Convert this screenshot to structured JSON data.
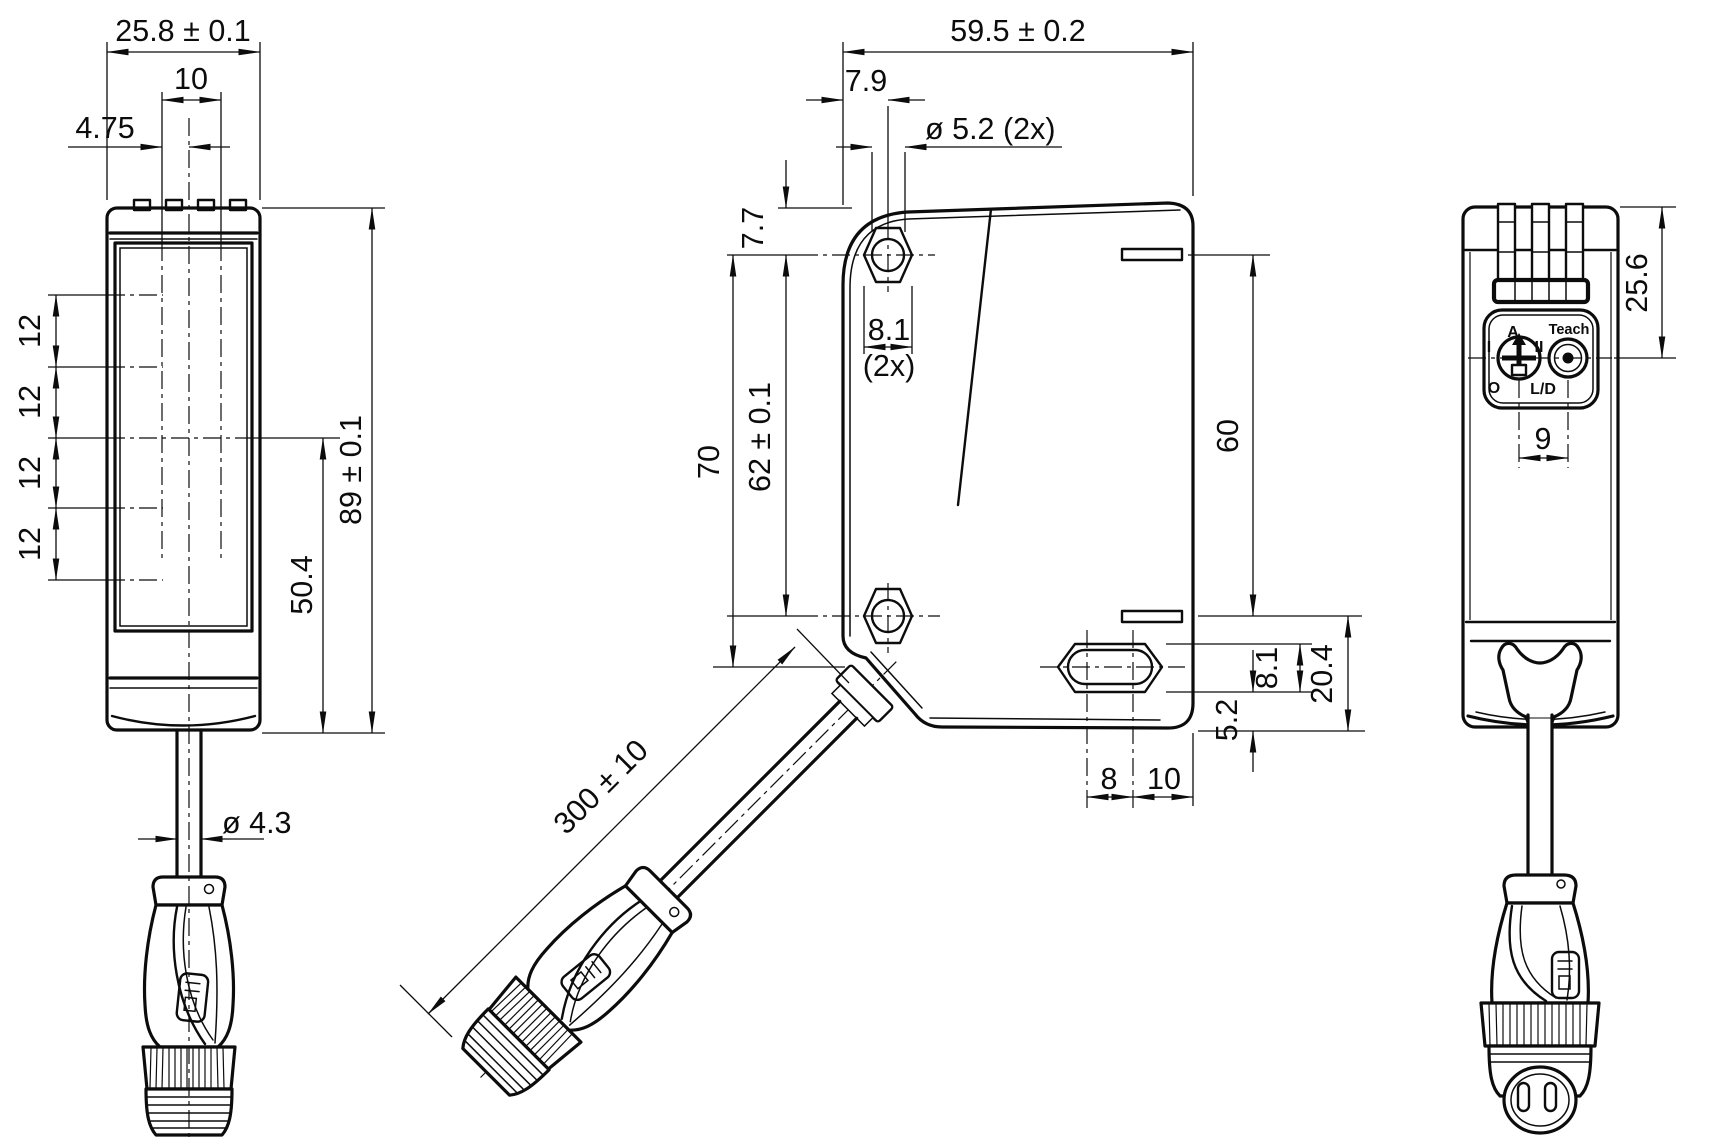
{
  "front": {
    "total_width": "25.8 ± 0.1",
    "window_width": "10",
    "axis_offset": "4.75",
    "beam_pitch": [
      "12",
      "12",
      "12",
      "12"
    ],
    "height": "89 ± 0.1",
    "axis_height": "50.4",
    "cable_dia": "ø 4.3"
  },
  "side": {
    "depth": "59.5 ± 0.2",
    "hole_offset": "7.9",
    "hole_dia": "ø 5.2 (2x)",
    "top_to_hole": "7.7",
    "hole_to_slot": "70",
    "hole_pitch": "62 ± 0.1",
    "hex_width": "8.1",
    "hex_qty": "(2x)",
    "back_pitch": "60",
    "slot_width": "8.1",
    "slot_zone": "20.4",
    "slot_to_bottom": "5.2",
    "slot_len": "8",
    "slot_to_back": "10",
    "cable_length": "300 ± 10"
  },
  "back": {
    "top_to_axis": "25.6",
    "control_pitch": "9",
    "pot": {
      "a": "A",
      "i": "I",
      "ii": "II",
      "o": "O",
      "ld": "L/D"
    },
    "teach": "Teach"
  }
}
